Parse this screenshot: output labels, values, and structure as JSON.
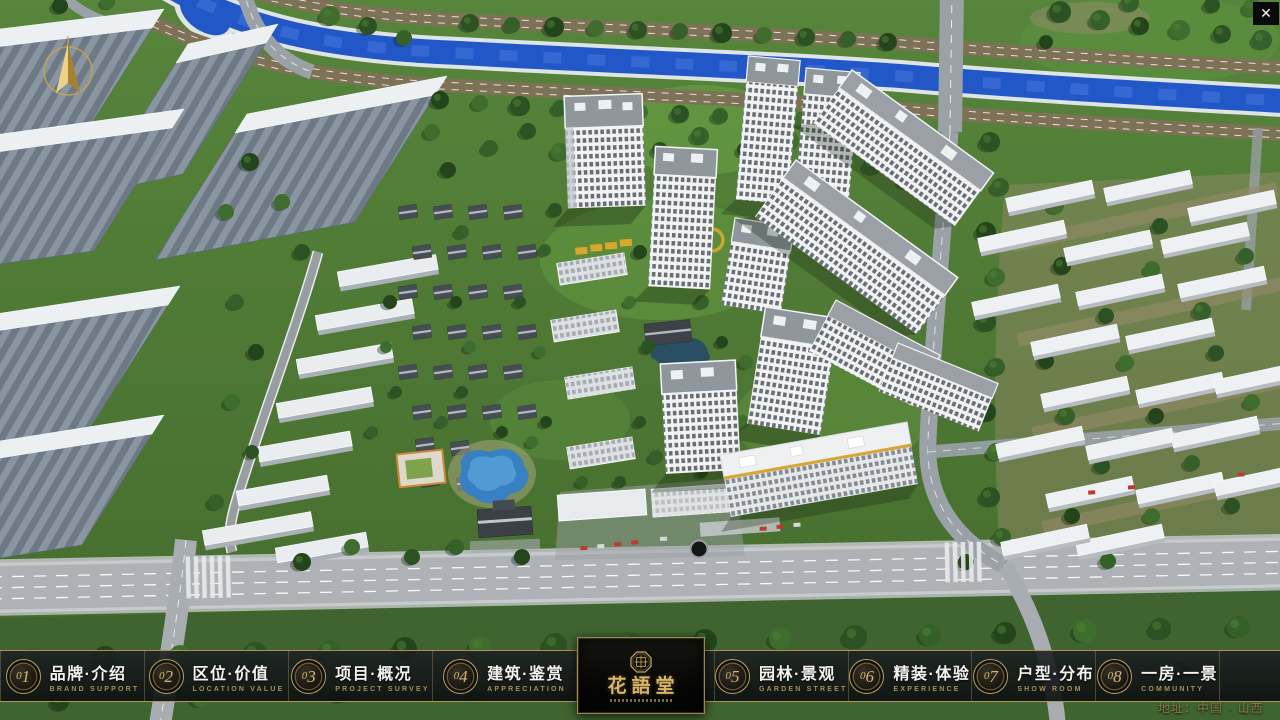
{
  "window": {
    "close_glyph": "✕"
  },
  "logo": {
    "title": "花語堂"
  },
  "nav": {
    "items": [
      {
        "num": "01",
        "label": "品牌·介绍",
        "sub": "BRAND SUPPORT"
      },
      {
        "num": "02",
        "label": "区位·价值",
        "sub": "LOCATION VALUE"
      },
      {
        "num": "03",
        "label": "项目·概况",
        "sub": "PROJECT SURVEY"
      },
      {
        "num": "04",
        "label": "建筑·鉴赏",
        "sub": "APPRECIATION"
      },
      {
        "num": "05",
        "label": "园林·景观",
        "sub": "GARDEN STREET"
      },
      {
        "num": "06",
        "label": "精装·体验",
        "sub": "EXPERIENCE"
      },
      {
        "num": "07",
        "label": "户型·分布",
        "sub": "SHOW ROOM"
      },
      {
        "num": "08",
        "label": "一房·一景",
        "sub": "COMMUNITY"
      }
    ]
  },
  "footer": {
    "address": "地址：中国 · 山西"
  },
  "colors": {
    "gold": "#c9a95f",
    "gold_dim": "#8d7c4e",
    "bar_bg": "rgba(14,16,18,0.88)",
    "river": "#2257c8"
  }
}
